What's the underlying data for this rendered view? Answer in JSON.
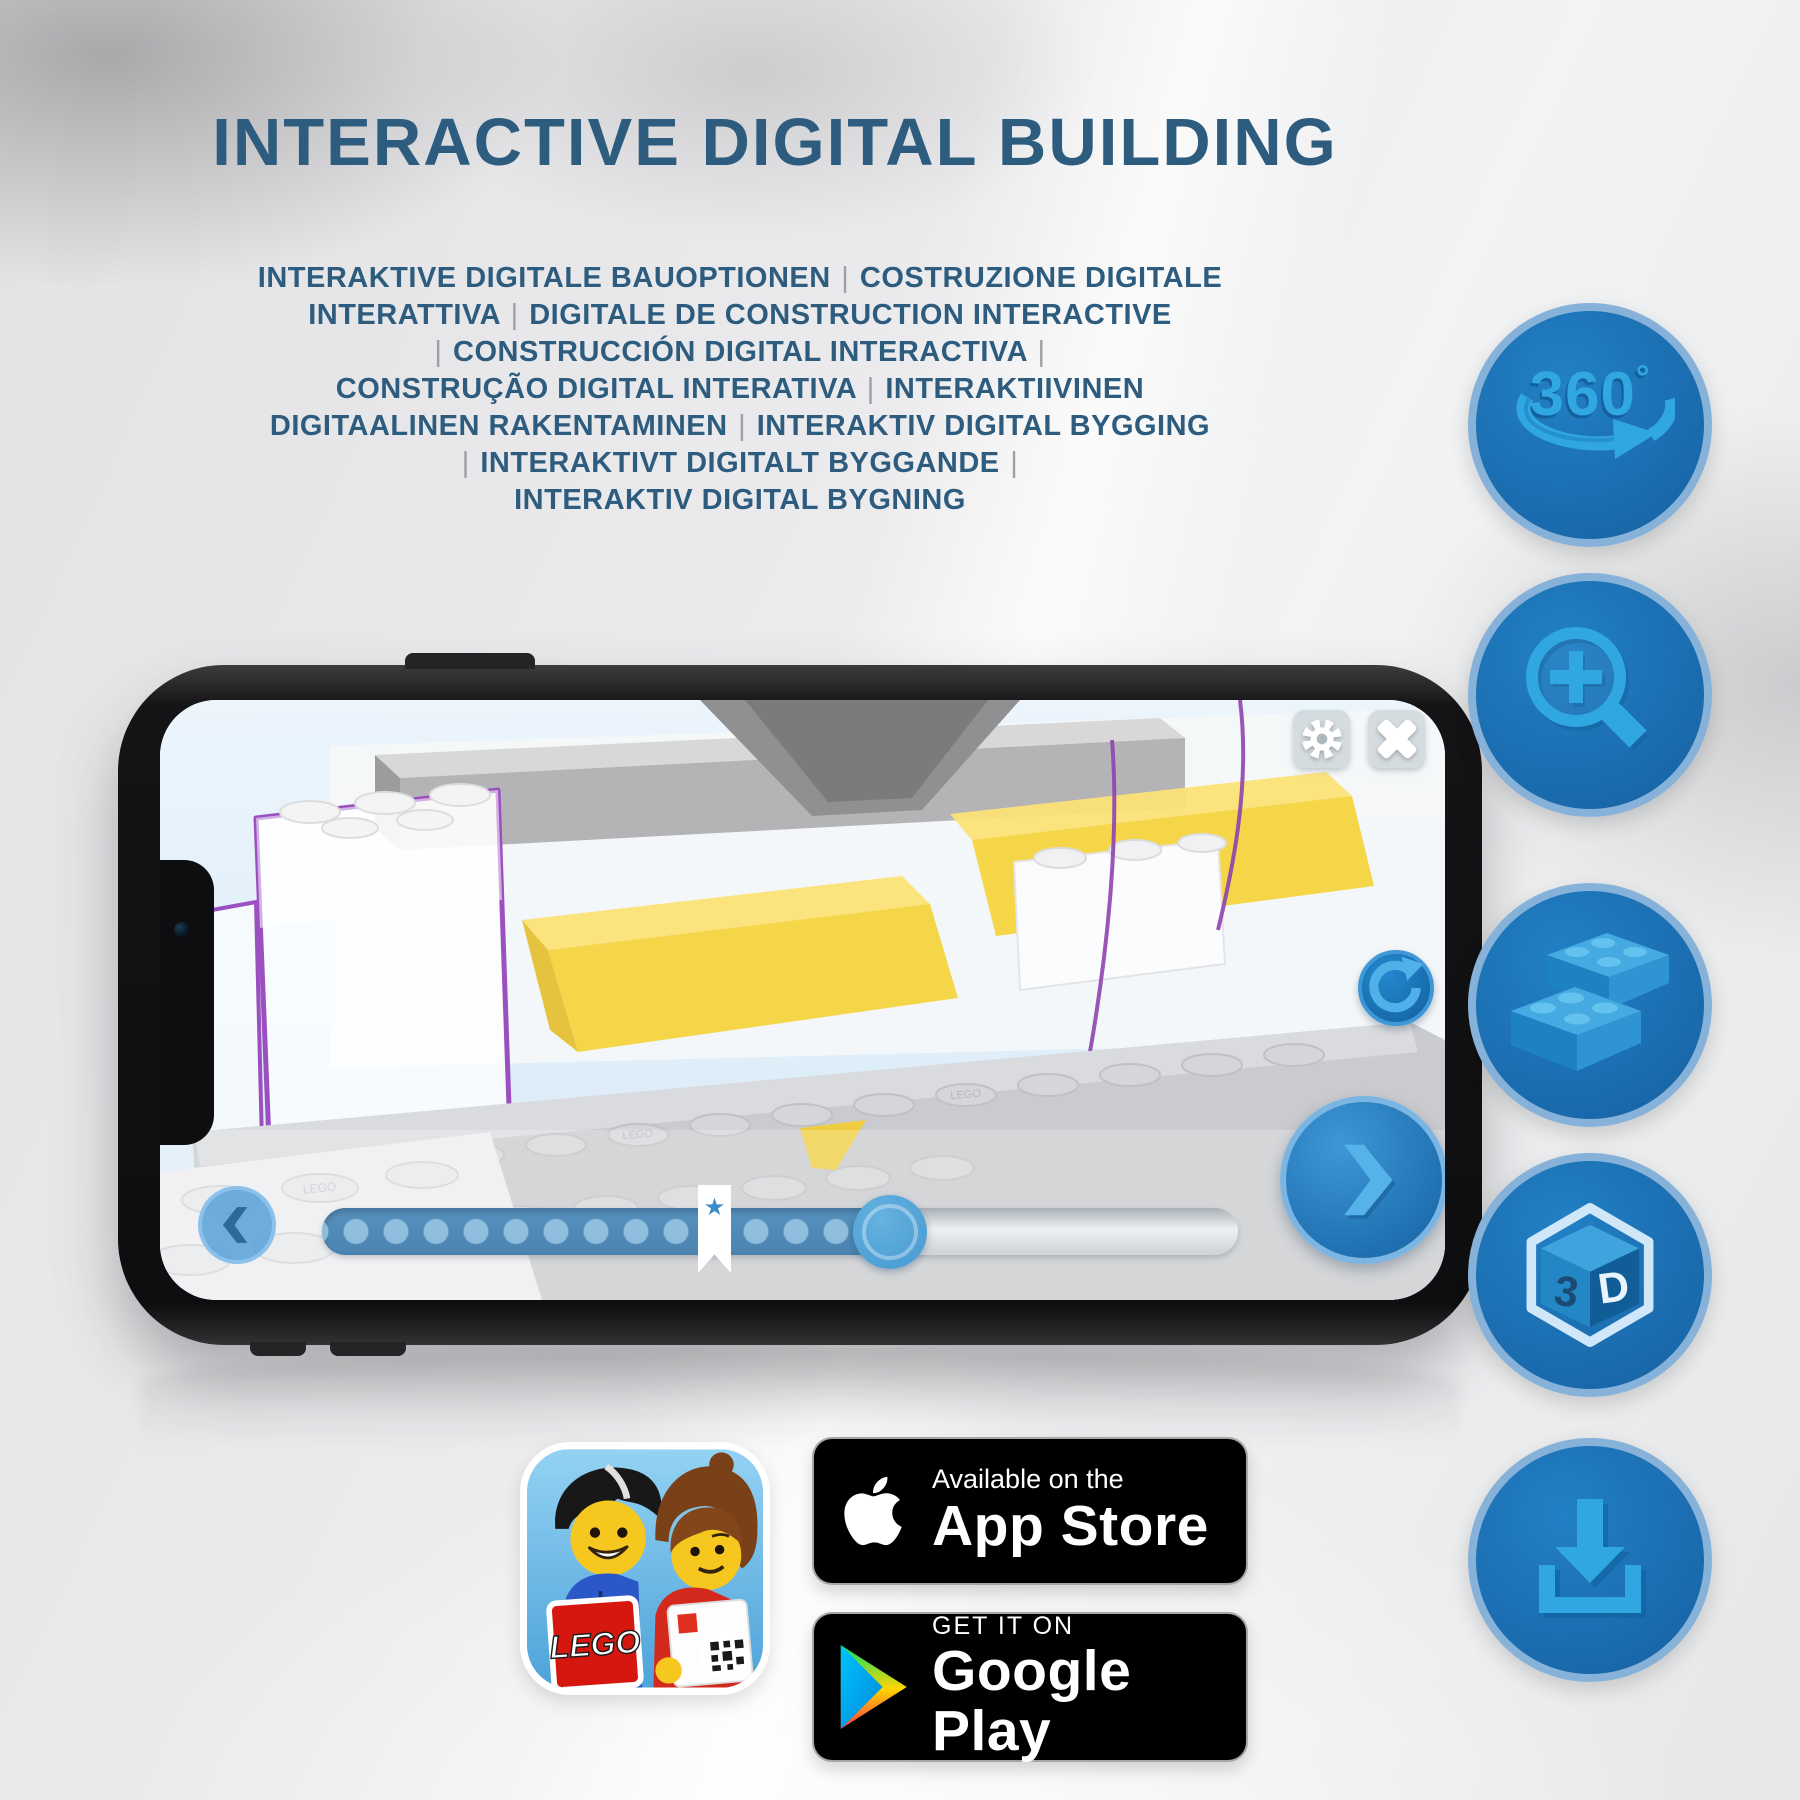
{
  "header": {
    "title": "INTERACTIVE DIGITAL BUILDING",
    "subtitle_lines": [
      "INTERAKTIVE DIGITALE BAUOPTIONEN | COSTRUZIONE DIGITALE",
      "INTERATTIVA | DIGITALE DE CONSTRUCTION INTERACTIVE",
      "| CONSTRUCCIÓN DIGITAL INTERACTIVA |",
      "CONSTRUÇÃO DIGITAL INTERATIVA | INTERAKTIIVINEN",
      "DIGITAALINEN RAKENTAMINEN | INTERAKTIV DIGITAL BYGGING",
      "| INTERAKTIVT DIGITALT BYGGANDE |",
      "INTERAKTIV DIGITAL BYGNING"
    ]
  },
  "feature_icons": {
    "rotation": {
      "number": "360",
      "degree": "°"
    },
    "zoom": {
      "icon": "magnifier-plus"
    },
    "brick": {
      "icon": "lego-bricks"
    },
    "three_d": {
      "left": "3",
      "right": "D"
    },
    "download": {
      "icon": "download-tray-arrow"
    }
  },
  "phone": {
    "scene_stud_text": "LEGO"
  },
  "badges": {
    "app_store": {
      "line1": "Available on the",
      "line2": "App Store"
    },
    "google_play": {
      "line1": "GET IT ON",
      "line2": "Google Play"
    }
  },
  "app_icon": {
    "logo_text": "LEGO"
  },
  "icons": {
    "settings": "gear",
    "close": "x-cross",
    "rotate": "circular-arrow",
    "previous": "chevron-left",
    "next": "chevron-right",
    "milestone": "star-bookmark"
  },
  "colors": {
    "title_blue": "#2d5c7e",
    "icon_circle_blue": "#1b74bb",
    "icon_glyph_blue": "#31a7e2",
    "screen_sky": "#e0eefa",
    "progress_fill": "#4a83b0",
    "brick_yellow": "#f5d23a",
    "outline_purple": "#9b50c0"
  }
}
